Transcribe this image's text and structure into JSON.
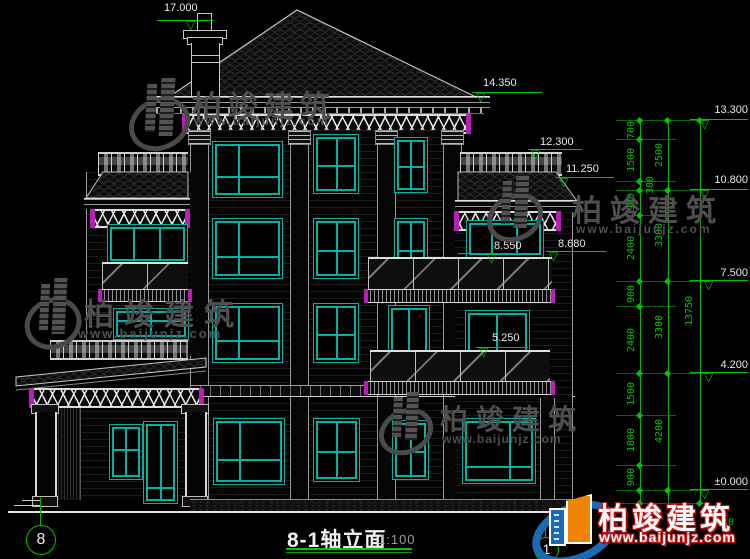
{
  "drawing": {
    "title": "8-1轴立面",
    "scale": "1:100",
    "levels": {
      "roof_top": "17.000",
      "main_eave": "14.350",
      "parapet": "13.300",
      "wing_rail": "12.300",
      "wing_eave": "11.250",
      "floor4": "10.800",
      "balcony_rail_b": "8.680",
      "balcony_rail_a": "8.550",
      "floor3": "7.500",
      "balcony_low": "5.250",
      "floor2": "4.200",
      "ground": "±0.000"
    },
    "dims": {
      "col1": [
        "700",
        "1500",
        "300",
        "900",
        "2400",
        "900",
        "2400",
        "1500",
        "1800",
        "900"
      ],
      "col2": [
        "2500",
        "3300",
        "3300",
        "4200"
      ],
      "col3": [
        "13750"
      ],
      "foundation": "450"
    },
    "axes": [
      {
        "label": "8"
      },
      {
        "label": "1"
      }
    ]
  },
  "watermark": {
    "brand": "柏竣建筑",
    "url": "www.baijunjz.com"
  },
  "colors": {
    "background": "#000000",
    "window_frame": "#00b3a6",
    "dimension_green": "#00c400",
    "accent_magenta": "#b71fb7",
    "line_white": "#d0d0d0",
    "watermark_gray": "#4f4f4f",
    "logo_blue": "#1a6ab5",
    "logo_orange": "#f08300",
    "logo_red": "#cc1111"
  }
}
